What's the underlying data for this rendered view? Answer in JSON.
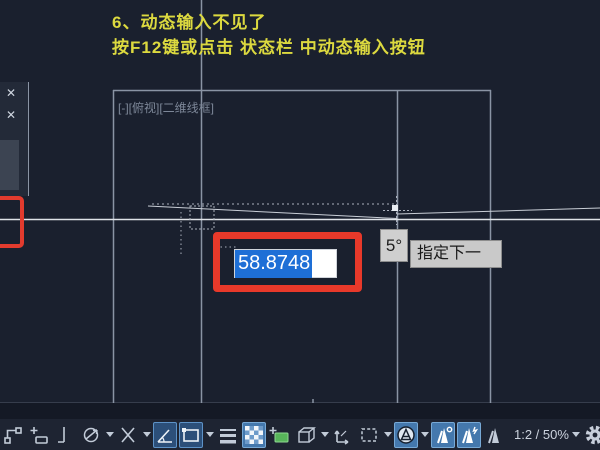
{
  "annotation": {
    "line1": "6、动态输入不见了",
    "line2": "按F12键或点击 状态栏  中动态输入按钮",
    "text_color": "#dcd93f"
  },
  "viewport_label": "[-][俯视][二维线框]",
  "dynamic_input": {
    "value": "58.8748",
    "angle": "5°",
    "prompt": "指定下一",
    "selection_color": "#1e6fd6",
    "highlight_box_color": "#e8392a"
  },
  "status_bar": {
    "scale_text": "1:2 / 50%",
    "icons": [
      {
        "name": "snap-mode-icon",
        "active": false,
        "dropdown": false
      },
      {
        "name": "grid-snap-icon",
        "active": false,
        "dropdown": false
      },
      {
        "name": "ortho-mode-icon",
        "active": false,
        "dropdown": false
      },
      {
        "name": "polar-tracking-icon",
        "active": false,
        "dropdown": true
      },
      {
        "name": "isometric-drafting-icon",
        "active": false,
        "dropdown": true
      },
      {
        "name": "object-snap-tracking-icon",
        "active": true,
        "dropdown": false
      },
      {
        "name": "object-snap-icon",
        "active": true,
        "dropdown": true
      },
      {
        "name": "lineweight-icon",
        "active": false,
        "dropdown": false
      },
      {
        "name": "transparency-icon",
        "active": true,
        "dropdown": false
      },
      {
        "name": "quick-properties-icon",
        "active": false,
        "dropdown": false
      },
      {
        "name": "dynamic-ucs-icon",
        "active": false,
        "dropdown": true
      },
      {
        "name": "ucs-axes-icon",
        "active": false,
        "dropdown": false
      },
      {
        "name": "selection-filter-icon",
        "active": false,
        "dropdown": true
      },
      {
        "name": "annotation-monitor-icon",
        "active": true,
        "dropdown": true
      },
      {
        "name": "annotation-visibility-icon",
        "active": true,
        "dropdown": false
      },
      {
        "name": "annotation-autoscale-icon",
        "active": true,
        "dropdown": false
      },
      {
        "name": "annotation-scale-icon",
        "active": false,
        "dropdown": false
      },
      {
        "name": "viewport-scale-value",
        "active": false,
        "dropdown": true
      },
      {
        "name": "customization-gear-icon",
        "active": false,
        "dropdown": false
      }
    ]
  },
  "palette": {
    "close_icons": 2
  },
  "colors": {
    "background": "#1a202e",
    "grid_line": "#8a94a4",
    "drawing_line": "#dfe3e8",
    "statusbar_bg": "#1e2432",
    "active_button_bg": "#2c4f79",
    "active_button_border": "#5d92c7"
  }
}
